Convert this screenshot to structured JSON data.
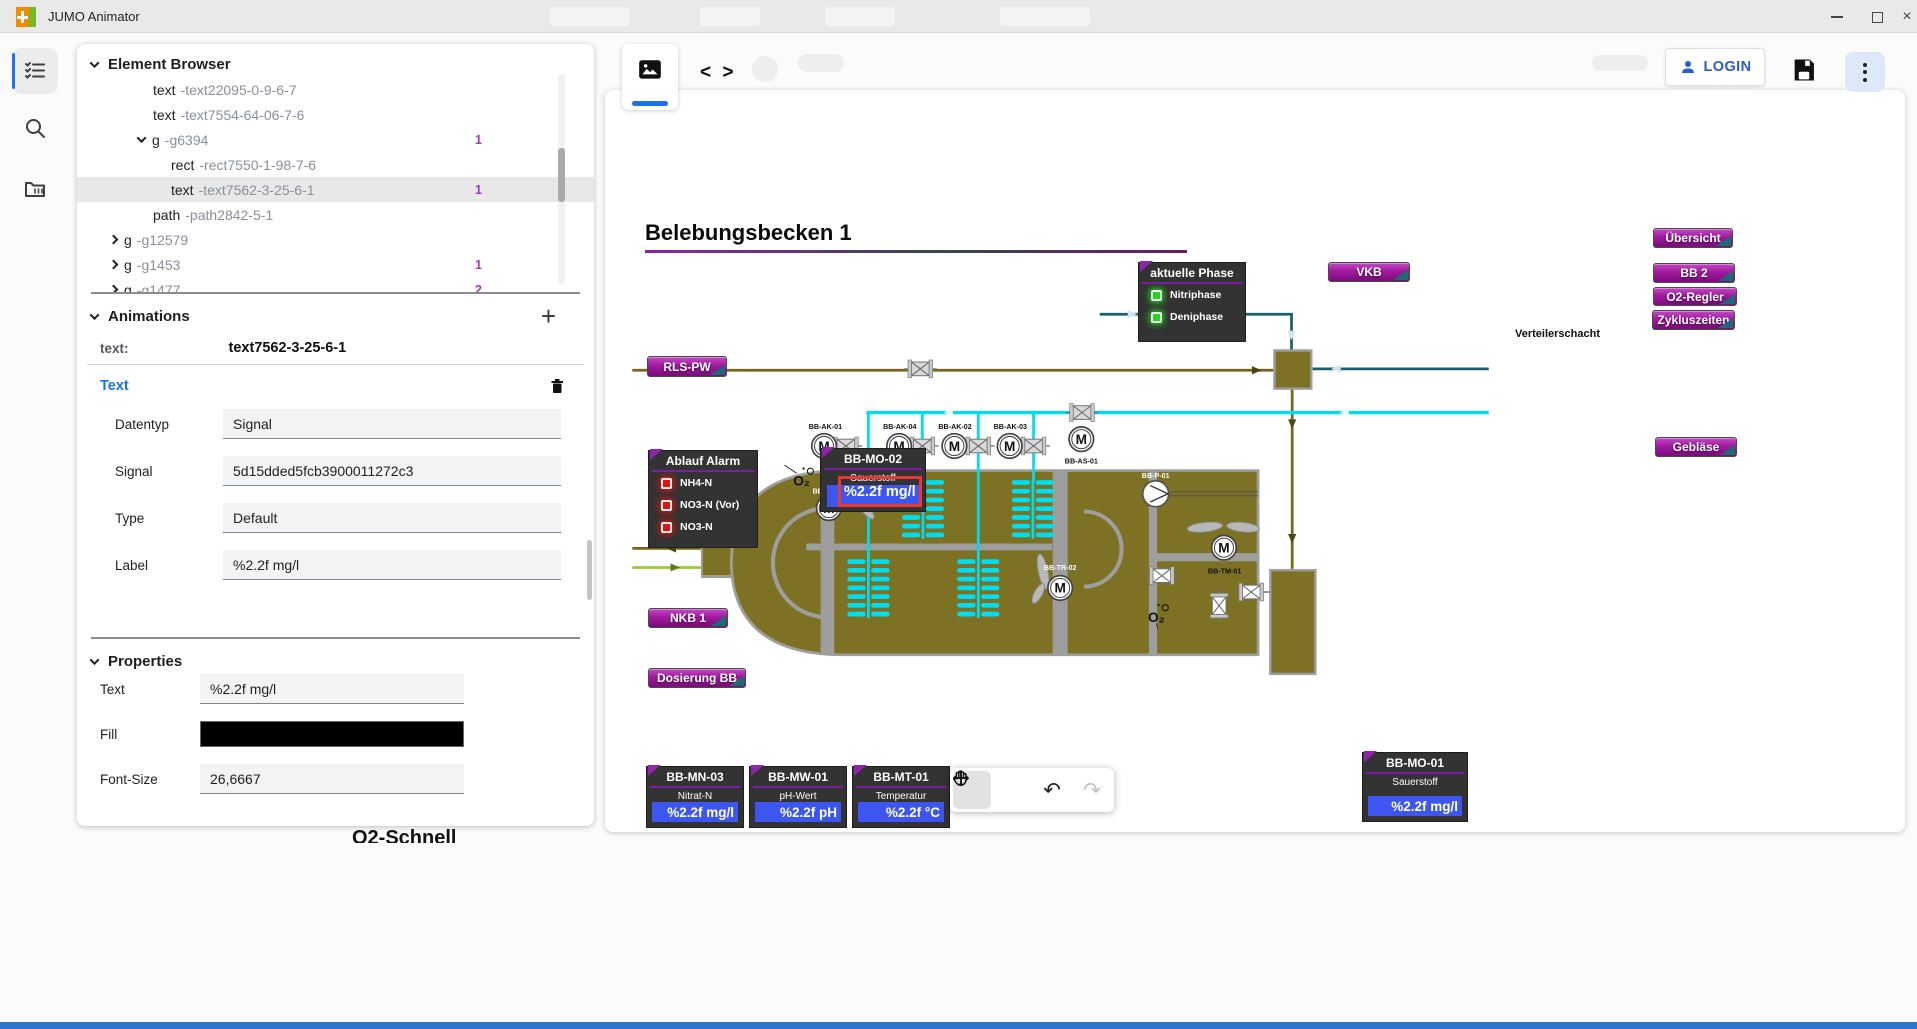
{
  "window": {
    "title": "JUMO Animator",
    "controls": [
      "minimize",
      "maximize",
      "close"
    ]
  },
  "rail": {
    "items": [
      "element-browser",
      "search",
      "library"
    ]
  },
  "element_browser": {
    "title": "Element Browser",
    "rows": [
      {
        "tag": "text",
        "id": "-text22095-0-9-6-7",
        "level": 2
      },
      {
        "tag": "text",
        "id": "-text7554-64-06-7-6",
        "level": 2
      },
      {
        "tag": "g",
        "id": "-g6394",
        "level": 1,
        "chevron": "down",
        "badge": "1"
      },
      {
        "tag": "rect",
        "id": "-rect7550-1-98-7-6",
        "level": 3
      },
      {
        "tag": "text",
        "id": "-text7562-3-25-6-1",
        "level": 3,
        "selected": true,
        "badge": "1"
      },
      {
        "tag": "path",
        "id": "-path2842-5-1",
        "level": 2
      },
      {
        "tag": "g",
        "id": "-g12579",
        "level": 0,
        "chevron": "right"
      },
      {
        "tag": "g",
        "id": "-g1453",
        "level": 0,
        "chevron": "right",
        "badge": "1"
      },
      {
        "tag": "g",
        "id": "-g1477",
        "level": 0,
        "chevron": "right",
        "badge": "2"
      }
    ]
  },
  "animations": {
    "title": "Animations",
    "add_label": "+",
    "target": {
      "label": "text:",
      "value": "text7562-3-25-6-1"
    },
    "group_title": "Text",
    "fields": [
      {
        "label": "Datentyp",
        "value": "Signal"
      },
      {
        "label": "Signal",
        "value": "5d15dded5fcb3900011272c3"
      },
      {
        "label": "Type",
        "value": "Default"
      },
      {
        "label": "Label",
        "value": "%2.2f mg/l"
      }
    ]
  },
  "properties": {
    "title": "Properties",
    "fields": [
      {
        "label": "Text",
        "value": "%2.2f mg/l",
        "type": "input"
      },
      {
        "label": "Fill",
        "value": "#000000",
        "type": "swatch"
      },
      {
        "label": "Font-Size",
        "value": "26,6667",
        "type": "input"
      }
    ]
  },
  "header": {
    "login_label": "LOGIN"
  },
  "canvas": {
    "title": "Belebungsbecken 1",
    "phase_box": {
      "title": "aktuelle Phase",
      "items": [
        "Nitriphase",
        "Deniphase"
      ]
    },
    "alarm_box": {
      "title": "Ablauf Alarm",
      "items": [
        "NH4-N",
        "NO3-N (Vor)",
        "NO3-N"
      ]
    },
    "nav_buttons": [
      "RLS-PW",
      "VKB",
      "Übersicht",
      "BB 2",
      "O2-Regler",
      "Zykluszeiten",
      "Gebläse",
      "NKB 1",
      "Dosierung BB"
    ],
    "verteilerschacht_label": "Verteilerschacht",
    "sensors": {
      "mo02": {
        "title": "BB-MO-02",
        "sub": "Sauerstoff",
        "value": "%2.2f mg/l"
      },
      "mn03": {
        "title": "BB-MN-03",
        "sub": "Nitrat-N",
        "value": "%2.2f mg/l"
      },
      "mw01": {
        "title": "BB-MW-01",
        "sub": "pH-Wert",
        "value": "%2.2f pH"
      },
      "mt01": {
        "title": "BB-MT-01",
        "sub": "Temperatur",
        "value": "%2.2f °C"
      },
      "mo01": {
        "title": "BB-MO-01",
        "sub": "Sauerstoff",
        "value": "%2.2f mg/l"
      }
    },
    "equipment": [
      "BB-AK-01",
      "BB-AK-04",
      "BB-AK-02",
      "BB-AK-03",
      "BB-AS-01",
      "BB-TR-01",
      "BB-TR-02",
      "BB-P-01",
      "BB-TM-01"
    ],
    "motor_symbol": "M",
    "o2_symbol": "O₂"
  },
  "bottom_toolbar": {
    "tools": [
      "pan-hand",
      "move",
      "undo",
      "redo"
    ]
  },
  "background_text": "O2-Schnell",
  "colors": {
    "accent": "#1a73e8",
    "login_blue": "#2a5bd7",
    "badge_purple": "#a435c9",
    "selection_red": "#e53935",
    "value_blue": "#3d56f0",
    "led_green": "#23d523",
    "led_red": "#e31212",
    "basin_olive": "#7d7123",
    "pipe_olive": "#76671c",
    "pipe_teal": "#1a5f6e",
    "pipe_cyan": "#00dcf0",
    "pipe_green": "#9ccc2e",
    "wall_gray": "#9e9e9e",
    "dark_box": "#333333",
    "title_underline": "#7b1fa2"
  }
}
